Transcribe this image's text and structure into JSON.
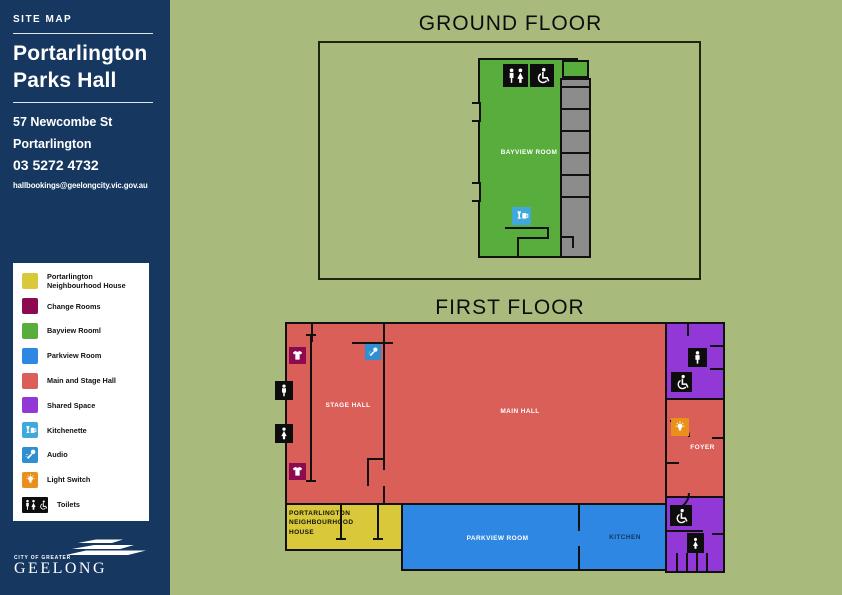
{
  "sidebar": {
    "eyebrow": "SITE MAP",
    "title": [
      "Portarlington",
      "Parks Hall"
    ],
    "address": [
      "57 Newcombe St",
      "Portarlington"
    ],
    "phone": "03 5272 4732",
    "email": "hallbookings@geelongcity.vic.gov.au",
    "logo_small": "CITY OF GREATER",
    "logo_large": "GEELONG"
  },
  "legend": {
    "items": [
      {
        "label": "Portarlington Neighbourhood House",
        "color": "#d9c93a",
        "icon": "swatch"
      },
      {
        "label": "Change Rooms",
        "color": "#8c0a50",
        "icon": "swatch"
      },
      {
        "label": "Bayview Rooml",
        "color": "#58ad3d",
        "icon": "swatch"
      },
      {
        "label": "Parkview Room",
        "color": "#2e87e2",
        "icon": "swatch"
      },
      {
        "label": "Main and Stage Hall",
        "color": "#d95f58",
        "icon": "swatch"
      },
      {
        "label": "Shared Space",
        "color": "#9138d6",
        "icon": "swatch"
      },
      {
        "label": "Kitchenette",
        "color": "#3fa9dc",
        "icon": "kitchenette-icon"
      },
      {
        "label": "Audio",
        "color": "#2f8fd0",
        "icon": "audio-icon"
      },
      {
        "label": "Light Switch",
        "color": "#e9901c",
        "icon": "light-switch-icon"
      },
      {
        "label": "Toilets",
        "color": "#0d0d0d",
        "icon": "toilets-icon"
      }
    ]
  },
  "ground_floor": {
    "title": "GROUND FLOOR",
    "rooms": {
      "bayview": "BAYVIEW ROOM"
    }
  },
  "first_floor": {
    "title": "FIRST FLOOR",
    "rooms": {
      "stage_hall": "STAGE HALL",
      "main_hall": "MAIN HALL",
      "foyer": "FOYER",
      "parkview": "PARKVIEW ROOM",
      "kitchen": "KITCHEN",
      "neighbourhood_house": "PORTARLINGTON NEIGHBOURHOOD HOUSE"
    }
  },
  "colors": {
    "sidebar": "#163760",
    "background": "#a8bb7d",
    "neighbourhood_house": "#d9c93a",
    "change_rooms": "#8c0a50",
    "bayview": "#58ad3d",
    "parkview": "#2e87e2",
    "main_stage": "#d95f58",
    "shared": "#9138d6",
    "kitchenette": "#3fa9dc",
    "audio": "#2f8fd0",
    "light_switch": "#e9901c",
    "toilets": "#0d0d0d",
    "corridor_gray": "#8c8c8c",
    "kitchen_text": "#14365c"
  }
}
